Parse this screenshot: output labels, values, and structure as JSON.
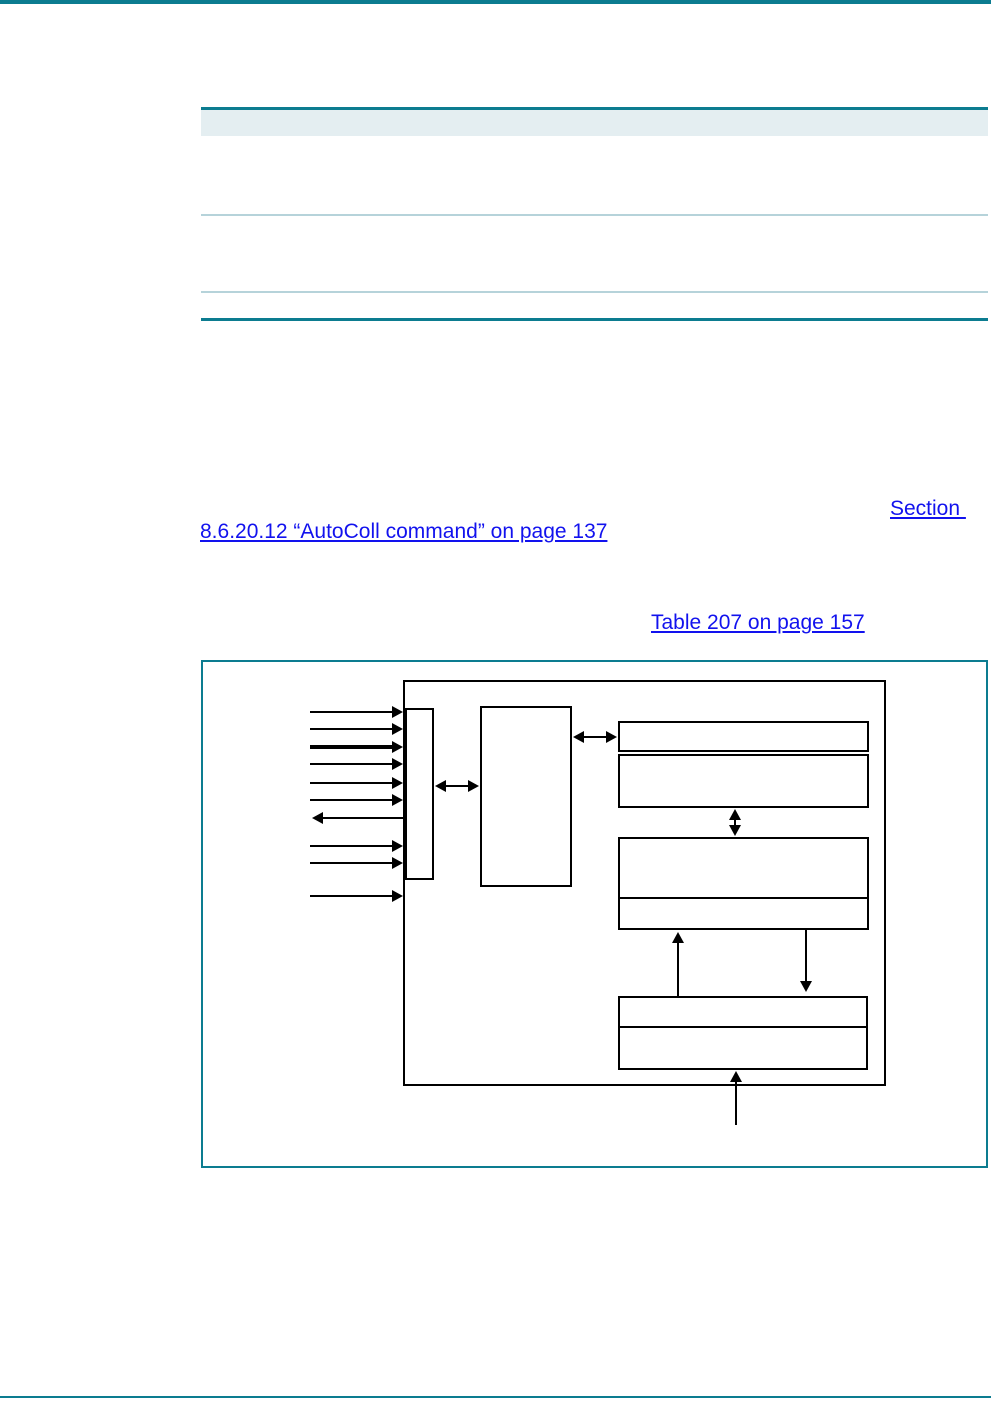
{
  "document": {
    "links": {
      "section_word": "Section ",
      "section_ref": "8.6.20.12 “AutoColl command” on page 137",
      "table_ref": "Table 207 on page 157"
    },
    "colors": {
      "accent_teal": "#0c7c90",
      "table_header_band": "#e4eef1",
      "table_row_rule": "#b6d3da",
      "link_blue": "#1212ee",
      "diagram_line": "#000000"
    }
  }
}
